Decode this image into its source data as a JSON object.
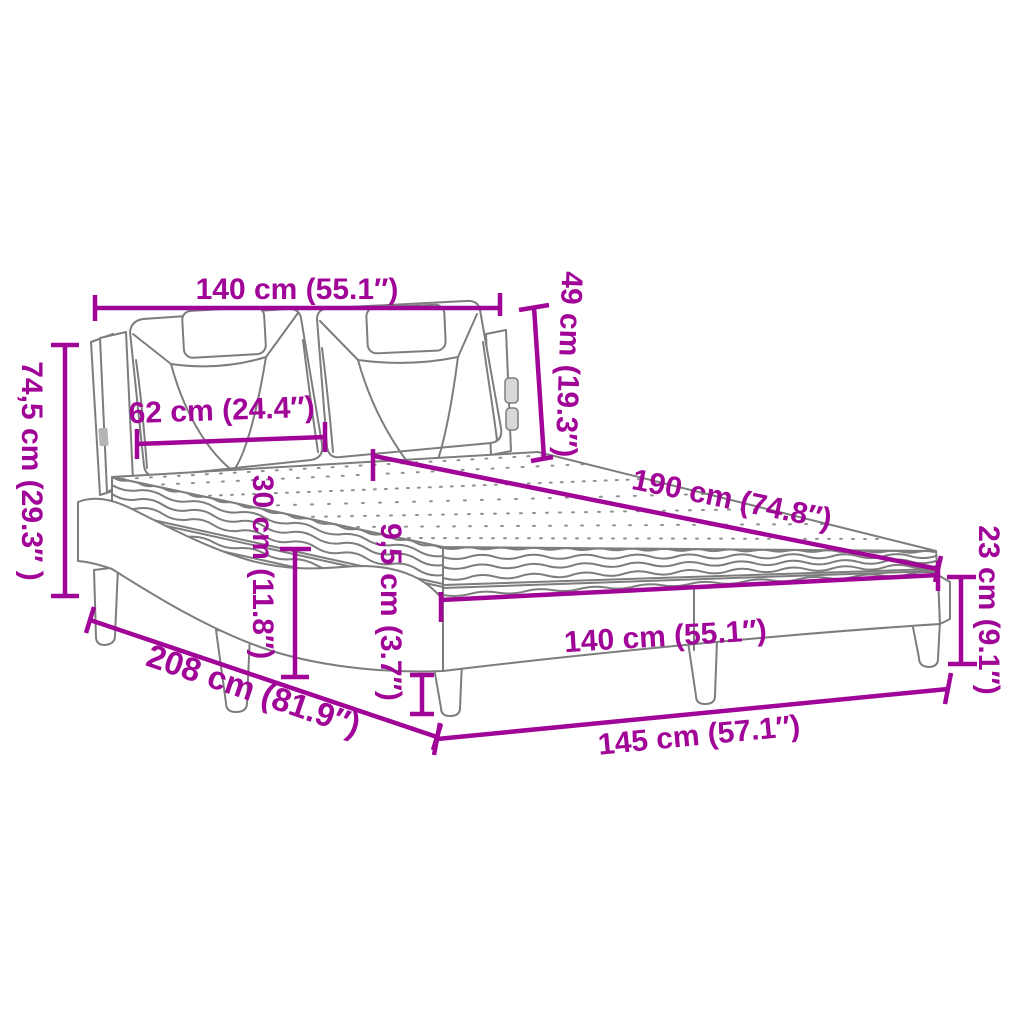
{
  "diagram": {
    "type": "product-dimension-diagram",
    "subject": "upholstered-bed-with-mattress",
    "accent_color": "#A00597",
    "line_color": "#7d7d7d",
    "background_color": "#ffffff",
    "labels": {
      "headboard_width_top": "140 cm (55.1″)",
      "headboard_height": "49 cm (19.3″)",
      "overall_height": "74,5 cm (29.3″ )",
      "cushion_width": "62 cm (24.4″)",
      "headboard_panel_height": "30 cm (11.8″)",
      "mattress_length": "190 cm (74.8″)",
      "leg_height": "9,5 cm (3.7″)",
      "frame_height": "23 cm (9.1″)",
      "frame_front_width": "140 cm (55.1″)",
      "overall_length": "208 cm (81.9″)",
      "overall_width": "145 cm (57.1″)"
    }
  }
}
